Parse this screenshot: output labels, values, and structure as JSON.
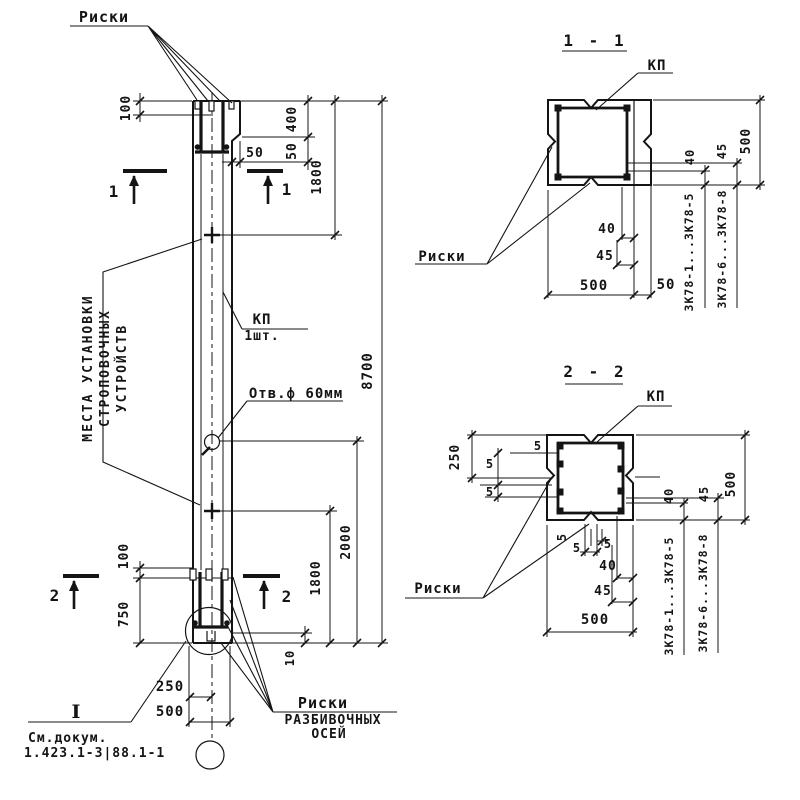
{
  "elevation": {
    "labels": {
      "riski_top": "Риски",
      "lifting_line1": "МЕСТА УСТАНОВКИ",
      "lifting_line2": "СТРОПОВОЧНЫХ",
      "lifting_line3": "УСТРОЙСТВ",
      "kp": "КП",
      "kp_qty": "1шт.",
      "hole": "Отв.ф 60мм",
      "axes_line1": "Риски",
      "axes_line2": "РАЗБИВОЧНЫХ",
      "axes_line3": "ОСЕЙ",
      "roman_one": "I",
      "see_doc_line1": "См.докум.",
      "see_doc_line2": "1.423.1-3|88.1-1"
    },
    "section_marks": {
      "s1": "1",
      "s2": "2"
    },
    "dims": {
      "d100_top": "100",
      "d400": "400",
      "d50_v": "50",
      "d50_h": "50",
      "d1800_top": "1800",
      "d8700": "8700",
      "d2000": "2000",
      "d1800_bot": "1800",
      "d10": "10",
      "d100_bot": "100",
      "d750": "750",
      "d250": "250",
      "d500": "500"
    }
  },
  "section11": {
    "title": "1 - 1",
    "kp": "КП",
    "riski": "Риски",
    "dims": {
      "d500_r": "500",
      "d40_r": "40",
      "d45_r": "45",
      "d40_b": "40",
      "d45_b": "45",
      "d500_b": "500",
      "d50_b": "50"
    },
    "series1": "3К78-1...3К78-5",
    "series2": "3К78-6...3К78-8"
  },
  "section22": {
    "title": "2 - 2",
    "kp": "КП",
    "riski": "Риски",
    "dims": {
      "d250": "250",
      "d500_r": "500",
      "d40_r": "40",
      "d45_r": "45",
      "d40_b": "40",
      "d45_b": "45",
      "d500_b": "500",
      "d5a": "5",
      "d5b": "5",
      "d5c": "5",
      "d5d": "5",
      "d5e": "5",
      "d5f": "5"
    },
    "series1": "3К78-1...3К78-5",
    "series2": "3К78-6...3К78-8"
  }
}
